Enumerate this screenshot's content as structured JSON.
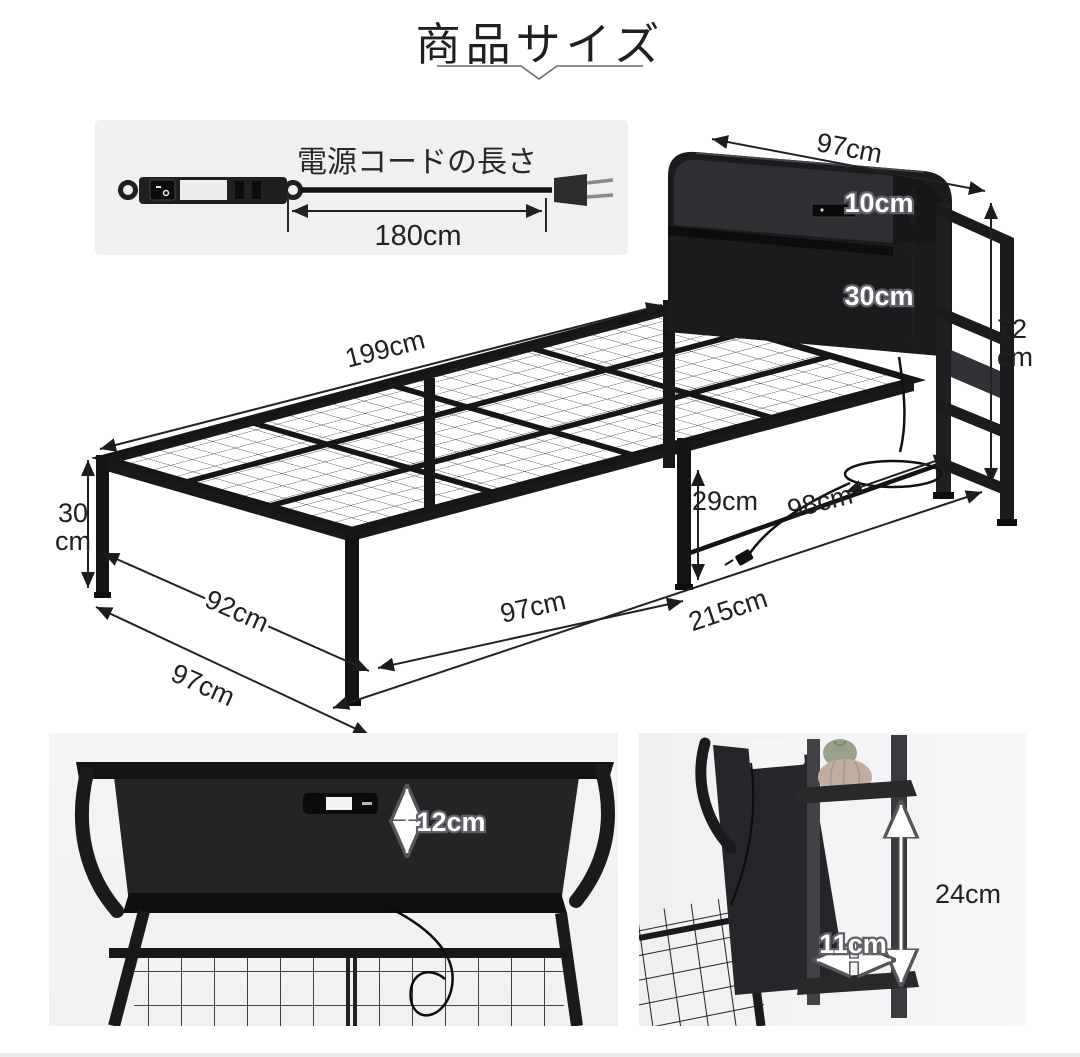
{
  "title": {
    "text": "商品サイズ"
  },
  "cord_inset": {
    "label": "電源コードの長さ",
    "length_label": "180cm"
  },
  "diagram_labels": {
    "headboard_width": "97cm",
    "headboard_shelf_height": "10cm",
    "headboard_panel_height": "30cm",
    "headboard_total_height_value": "72",
    "headboard_total_height_unit": "cm",
    "platform_length": "199cm",
    "foot_leg_height_value": "30",
    "foot_leg_height_unit": "cm",
    "inner_width": "92cm",
    "outer_width": "97cm",
    "front_leg_spacing": "97cm",
    "total_length": "215cm",
    "under_bed_clearance": "29cm",
    "under_bed_depth": "98cm"
  },
  "photo_left_labels": {
    "shelf_depth": "12cm"
  },
  "photo_right_labels": {
    "side_shelf_height": "24cm",
    "side_shelf_depth": "11cm"
  },
  "colors": {
    "ink": "#1c1c1e",
    "dimension_line": "#222226",
    "bubble_text": "#ffffff",
    "inset_bg": "#f0f0f1",
    "photo_bg": "#f3f3f4"
  }
}
